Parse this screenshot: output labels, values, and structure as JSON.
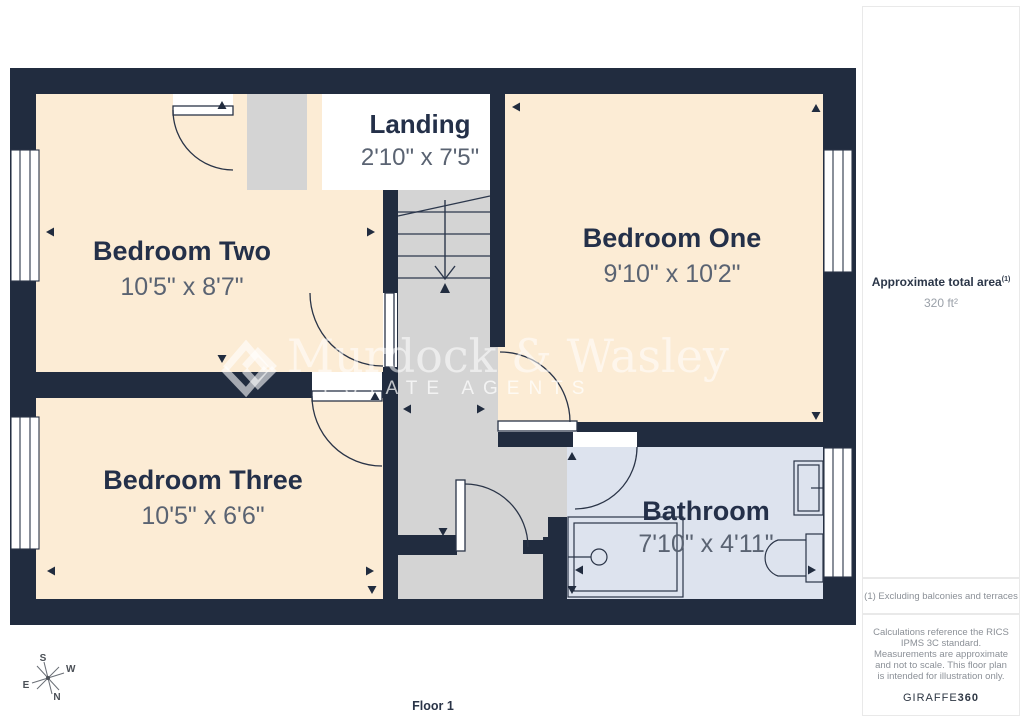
{
  "plan": {
    "floor_label": "Floor 1",
    "rooms": [
      {
        "name": "Landing",
        "dims": "2'10\" x 7'5\""
      },
      {
        "name": "Bedroom Two",
        "dims": "10'5\" x 8'7\""
      },
      {
        "name": "Bedroom One",
        "dims": "9'10\" x 10'2\""
      },
      {
        "name": "Bedroom Three",
        "dims": "10'5\" x 6'6\""
      },
      {
        "name": "Bathroom",
        "dims": "7'10\" x 4'11\""
      }
    ],
    "compass": {
      "n": "N",
      "s": "S",
      "e": "E",
      "w": "W"
    },
    "watermark": {
      "brand": "Murdock & Wasley",
      "tagline": "ESTATE AGENTS"
    },
    "colors": {
      "wall": "#212c3f",
      "room_fill": "#fcecd5",
      "hall_fill": "#d4d4d4",
      "bathroom_fill": "#dde3ee",
      "label_text": "#243049",
      "dims_text": "#5a6372"
    }
  },
  "sidebar": {
    "total_area_label": "Approximate total area",
    "total_area_footnote_marker": "(1)",
    "total_area_value": "320 ft²",
    "footnote": "(1) Excluding balconies and terraces",
    "disclaimer": "Calculations reference the RICS IPMS 3C standard. Measurements are approximate and not to scale. This floor plan is intended for illustration only.",
    "brand_name": "GIRAFFE",
    "brand_suffix": "360"
  }
}
